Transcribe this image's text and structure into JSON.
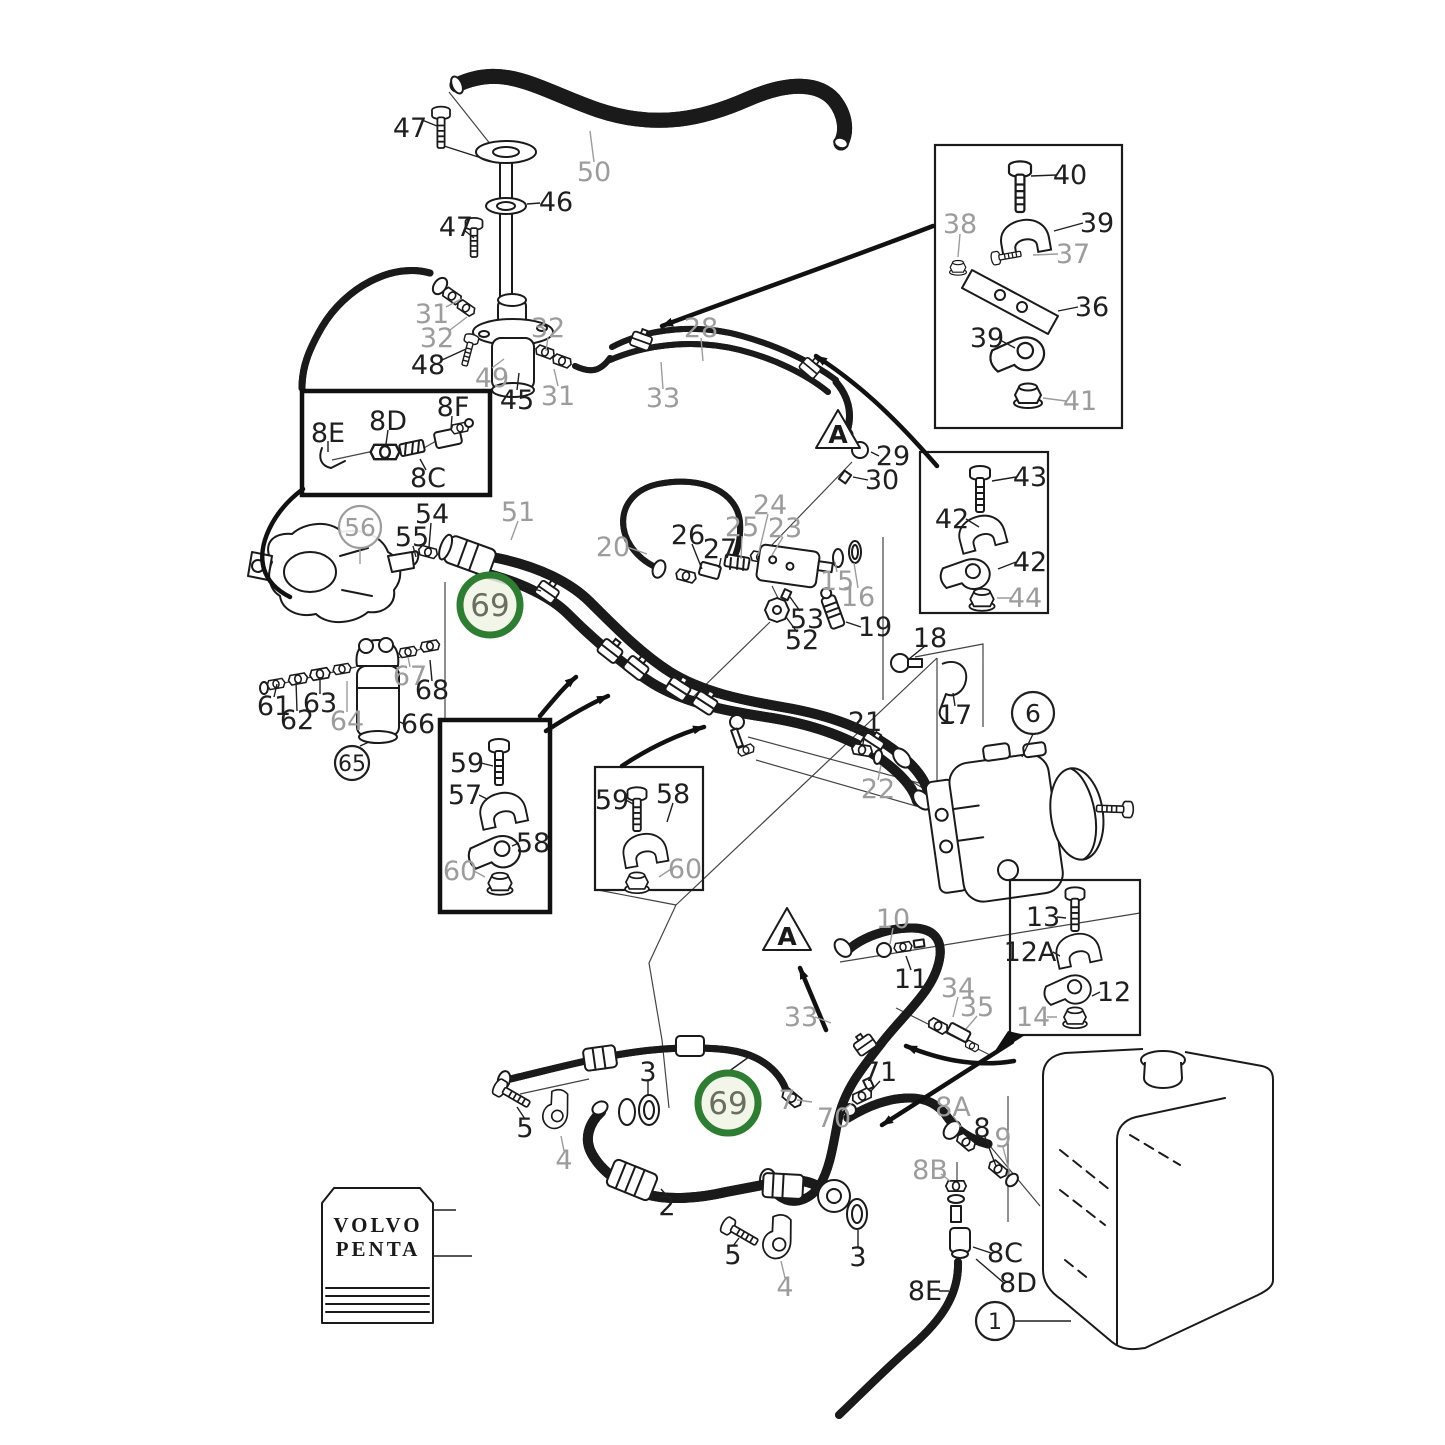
{
  "colors": {
    "line": "#1a1a1a",
    "muted_label": "#9c9c9c",
    "black_label": "#1f1f1f",
    "highlight_ring": "#2e7d32",
    "highlight_fill": "#eef4e4",
    "highlight_text": "#6a6e60",
    "background": "#ffffff"
  },
  "logo": {
    "line1": "VOLVO",
    "line2": "PENTA"
  },
  "warning_triangle": {
    "letter": "A"
  },
  "labels": [
    {
      "t": "47",
      "x": 410,
      "y": 128,
      "tone": "b"
    },
    {
      "t": "50",
      "x": 594,
      "y": 172,
      "tone": "g"
    },
    {
      "t": "46",
      "x": 556,
      "y": 202,
      "tone": "b"
    },
    {
      "t": "47",
      "x": 456,
      "y": 227,
      "tone": "b"
    },
    {
      "t": "31",
      "x": 432,
      "y": 314,
      "tone": "g"
    },
    {
      "t": "32",
      "x": 437,
      "y": 338,
      "tone": "g"
    },
    {
      "t": "48",
      "x": 428,
      "y": 365,
      "tone": "b"
    },
    {
      "t": "49",
      "x": 492,
      "y": 378,
      "tone": "g"
    },
    {
      "t": "45",
      "x": 517,
      "y": 400,
      "tone": "b"
    },
    {
      "t": "31",
      "x": 558,
      "y": 396,
      "tone": "g"
    },
    {
      "t": "32",
      "x": 548,
      "y": 328,
      "tone": "g"
    },
    {
      "t": "28",
      "x": 701,
      "y": 328,
      "tone": "g"
    },
    {
      "t": "33",
      "x": 663,
      "y": 398,
      "tone": "g"
    },
    {
      "t": "40",
      "x": 1070,
      "y": 175,
      "tone": "b"
    },
    {
      "t": "39",
      "x": 1097,
      "y": 223,
      "tone": "b"
    },
    {
      "t": "38",
      "x": 960,
      "y": 224,
      "tone": "g"
    },
    {
      "t": "37",
      "x": 1073,
      "y": 254,
      "tone": "g"
    },
    {
      "t": "36",
      "x": 1092,
      "y": 307,
      "tone": "b"
    },
    {
      "t": "39",
      "x": 987,
      "y": 338,
      "tone": "b"
    },
    {
      "t": "41",
      "x": 1080,
      "y": 401,
      "tone": "g"
    },
    {
      "t": "8E",
      "x": 328,
      "y": 433,
      "tone": "b"
    },
    {
      "t": "8D",
      "x": 388,
      "y": 421,
      "tone": "b"
    },
    {
      "t": "8F",
      "x": 453,
      "y": 407,
      "tone": "b"
    },
    {
      "t": "8C",
      "x": 428,
      "y": 478,
      "tone": "b"
    },
    {
      "t": "54",
      "x": 432,
      "y": 514,
      "tone": "b"
    },
    {
      "t": "55",
      "x": 412,
      "y": 537,
      "tone": "b"
    },
    {
      "t": "51",
      "x": 518,
      "y": 512,
      "tone": "g"
    },
    {
      "t": "20",
      "x": 613,
      "y": 547,
      "tone": "g"
    },
    {
      "t": "26",
      "x": 688,
      "y": 535,
      "tone": "b"
    },
    {
      "t": "27",
      "x": 720,
      "y": 549,
      "tone": "b"
    },
    {
      "t": "25",
      "x": 742,
      "y": 527,
      "tone": "g"
    },
    {
      "t": "24",
      "x": 770,
      "y": 505,
      "tone": "g"
    },
    {
      "t": "23",
      "x": 785,
      "y": 528,
      "tone": "g"
    },
    {
      "t": "29",
      "x": 893,
      "y": 456,
      "tone": "b"
    },
    {
      "t": "30",
      "x": 882,
      "y": 480,
      "tone": "b"
    },
    {
      "t": "15",
      "x": 837,
      "y": 581,
      "tone": "g"
    },
    {
      "t": "16",
      "x": 858,
      "y": 597,
      "tone": "g"
    },
    {
      "t": "53",
      "x": 807,
      "y": 619,
      "tone": "b"
    },
    {
      "t": "52",
      "x": 802,
      "y": 640,
      "tone": "b"
    },
    {
      "t": "19",
      "x": 875,
      "y": 627,
      "tone": "b"
    },
    {
      "t": "43",
      "x": 1030,
      "y": 477,
      "tone": "b"
    },
    {
      "t": "42",
      "x": 952,
      "y": 519,
      "tone": "b"
    },
    {
      "t": "42",
      "x": 1030,
      "y": 562,
      "tone": "b"
    },
    {
      "t": "44",
      "x": 1025,
      "y": 598,
      "tone": "g"
    },
    {
      "t": "18",
      "x": 930,
      "y": 638,
      "tone": "b"
    },
    {
      "t": "17",
      "x": 955,
      "y": 715,
      "tone": "b"
    },
    {
      "t": "21",
      "x": 865,
      "y": 722,
      "tone": "b"
    },
    {
      "t": "22",
      "x": 878,
      "y": 789,
      "tone": "g"
    },
    {
      "t": "61",
      "x": 274,
      "y": 706,
      "tone": "b"
    },
    {
      "t": "62",
      "x": 297,
      "y": 720,
      "tone": "b"
    },
    {
      "t": "63",
      "x": 320,
      "y": 703,
      "tone": "b"
    },
    {
      "t": "64",
      "x": 347,
      "y": 721,
      "tone": "g"
    },
    {
      "t": "66",
      "x": 418,
      "y": 724,
      "tone": "b"
    },
    {
      "t": "67",
      "x": 410,
      "y": 676,
      "tone": "g"
    },
    {
      "t": "68",
      "x": 432,
      "y": 690,
      "tone": "b"
    },
    {
      "t": "59",
      "x": 467,
      "y": 763,
      "tone": "b"
    },
    {
      "t": "57",
      "x": 465,
      "y": 795,
      "tone": "b"
    },
    {
      "t": "58",
      "x": 533,
      "y": 843,
      "tone": "b"
    },
    {
      "t": "60",
      "x": 460,
      "y": 871,
      "tone": "g"
    },
    {
      "t": "59",
      "x": 612,
      "y": 800,
      "tone": "b"
    },
    {
      "t": "58",
      "x": 673,
      "y": 794,
      "tone": "b"
    },
    {
      "t": "60",
      "x": 685,
      "y": 869,
      "tone": "g"
    },
    {
      "t": "13",
      "x": 1043,
      "y": 917,
      "tone": "b"
    },
    {
      "t": "12A",
      "x": 1030,
      "y": 952,
      "tone": "b"
    },
    {
      "t": "12",
      "x": 1114,
      "y": 992,
      "tone": "b"
    },
    {
      "t": "14",
      "x": 1033,
      "y": 1017,
      "tone": "g"
    },
    {
      "t": "10",
      "x": 893,
      "y": 919,
      "tone": "g"
    },
    {
      "t": "11",
      "x": 911,
      "y": 979,
      "tone": "b"
    },
    {
      "t": "34",
      "x": 958,
      "y": 988,
      "tone": "g"
    },
    {
      "t": "35",
      "x": 977,
      "y": 1007,
      "tone": "g"
    },
    {
      "t": "33",
      "x": 801,
      "y": 1017,
      "tone": "g"
    },
    {
      "t": "3",
      "x": 648,
      "y": 1072,
      "tone": "b"
    },
    {
      "t": "7",
      "x": 787,
      "y": 1100,
      "tone": "g"
    },
    {
      "t": "71",
      "x": 880,
      "y": 1072,
      "tone": "b"
    },
    {
      "t": "70",
      "x": 834,
      "y": 1118,
      "tone": "g"
    },
    {
      "t": "8A",
      "x": 953,
      "y": 1107,
      "tone": "g"
    },
    {
      "t": "8",
      "x": 982,
      "y": 1128,
      "tone": "b"
    },
    {
      "t": "9",
      "x": 1003,
      "y": 1138,
      "tone": "g"
    },
    {
      "t": "8B",
      "x": 930,
      "y": 1170,
      "tone": "g"
    },
    {
      "t": "5",
      "x": 525,
      "y": 1128,
      "tone": "b"
    },
    {
      "t": "4",
      "x": 564,
      "y": 1160,
      "tone": "g"
    },
    {
      "t": "2",
      "x": 667,
      "y": 1206,
      "tone": "b"
    },
    {
      "t": "5",
      "x": 733,
      "y": 1255,
      "tone": "b"
    },
    {
      "t": "4",
      "x": 785,
      "y": 1287,
      "tone": "g"
    },
    {
      "t": "3",
      "x": 858,
      "y": 1257,
      "tone": "b"
    },
    {
      "t": "8C",
      "x": 1005,
      "y": 1253,
      "tone": "b"
    },
    {
      "t": "8D",
      "x": 1018,
      "y": 1283,
      "tone": "b"
    },
    {
      "t": "8E",
      "x": 925,
      "y": 1291,
      "tone": "b"
    }
  ],
  "circled_labels": [
    {
      "t": "56",
      "x": 360,
      "y": 527,
      "r": 21,
      "style": "plain-gray"
    },
    {
      "t": "65",
      "x": 352,
      "y": 763,
      "r": 17,
      "style": "plain-black"
    },
    {
      "t": "6",
      "x": 1033,
      "y": 713,
      "r": 21,
      "style": "plain-black"
    },
    {
      "t": "1",
      "x": 995,
      "y": 1321,
      "r": 19,
      "style": "plain-black"
    },
    {
      "t": "69",
      "x": 490,
      "y": 605,
      "r": 30,
      "style": "highlight"
    },
    {
      "t": "69",
      "x": 728,
      "y": 1103,
      "r": 30,
      "style": "highlight"
    }
  ]
}
